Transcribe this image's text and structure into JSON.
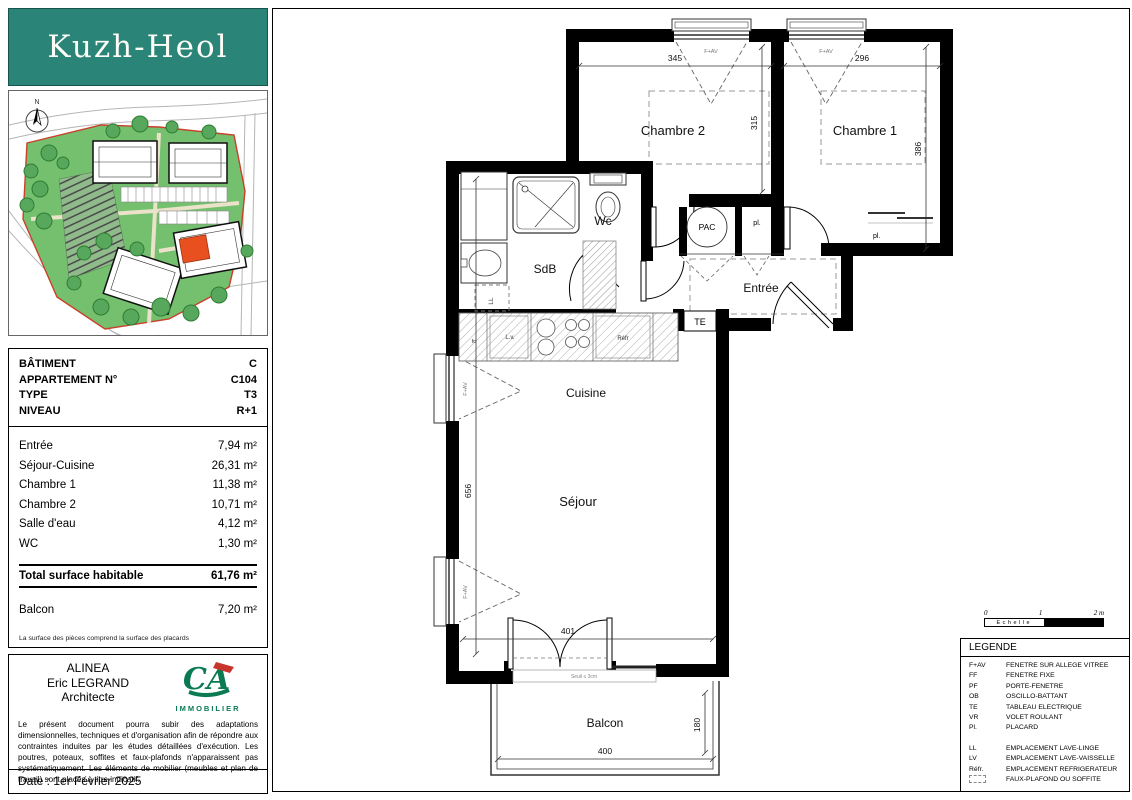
{
  "sidebar": {
    "brand": {
      "title": "Kuzh-Heol"
    },
    "info": {
      "rows": [
        {
          "label": "BÂTIMENT",
          "value": "C"
        },
        {
          "label": "APPARTEMENT N°",
          "value": "C104"
        },
        {
          "label": "TYPE",
          "value": "T3"
        },
        {
          "label": "NIVEAU",
          "value": "R+1"
        }
      ]
    },
    "areas": {
      "rows": [
        {
          "label": "Entrée",
          "value": "7,94 m²"
        },
        {
          "label": "Séjour-Cuisine",
          "value": "26,31 m²"
        },
        {
          "label": "Chambre 1",
          "value": "11,38 m²"
        },
        {
          "label": "Chambre 2",
          "value": "10,71 m²"
        },
        {
          "label": "Salle d'eau",
          "value": "4,12 m²"
        },
        {
          "label": "WC",
          "value": "1,30 m²"
        }
      ],
      "total": {
        "label": "Total surface habitable",
        "value": "61,76 m²"
      },
      "balcony": {
        "label": "Balcon",
        "value": "7,20 m²"
      },
      "footnote": "La surface des pièces comprend la surface des placards"
    },
    "architect": {
      "firm": "ALINEA",
      "name": "Eric LEGRAND",
      "role": "Architecte",
      "logo": "IMMOBILIER",
      "disclaimer": "Le présent document pourra subir des adaptations dimensionnelles, techniques et d'organisation afin de répondre aux contraintes induites par les études détaillées d'exécution. Les poutres, poteaux, soffites et faux-plafonds n'apparaissent pas systématiquement. Les éléments de mobilier (meubles et plan de travail) sont placés à titre indicatif.",
      "date": "Date : 1er Février 2025"
    }
  },
  "plan": {
    "rooms": {
      "chambre2": "Chambre 2",
      "chambre1": "Chambre 1",
      "wc": "Wc",
      "sdb": "SdB",
      "entree": "Entrée",
      "cuisine": "Cuisine",
      "sejour": "Séjour",
      "balcon": "Balcon"
    },
    "labels": {
      "pac": "PAC",
      "pl": "pl.",
      "te": "TE",
      "ll": "LL",
      "lv": "L.v.",
      "refr": "Réfr",
      "fo": "fo",
      "fav": "F+AV"
    },
    "dims": {
      "d345": "345",
      "d296": "296",
      "d315": "315",
      "d386": "386",
      "d656": "656",
      "d401": "401",
      "d400": "400",
      "d180": "180"
    },
    "threshold": "Seuil ≤ 3cm"
  },
  "scale": {
    "t0": "0",
    "t1": "1",
    "t2": "2 m",
    "label": "Echelle"
  },
  "legend": {
    "title": "LEGENDE",
    "group1": [
      {
        "abbr": "F+AV",
        "label": "FENETRE SUR ALLEGE VITREE"
      },
      {
        "abbr": "FF",
        "label": "FENETRE FIXE"
      },
      {
        "abbr": "PF",
        "label": "PORTE-FENETRE"
      },
      {
        "abbr": "OB",
        "label": "OSCILLO-BATTANT"
      },
      {
        "abbr": "TE",
        "label": "TABLEAU ELECTRIQUE"
      },
      {
        "abbr": "VR",
        "label": "VOLET ROULANT"
      },
      {
        "abbr": "Pl.",
        "label": "PLACARD"
      }
    ],
    "group2": [
      {
        "abbr": "LL",
        "label": "EMPLACEMENT LAVE-LINGE"
      },
      {
        "abbr": "LV",
        "label": "EMPLACEMENT LAVE-VAISSELLE"
      },
      {
        "abbr": "Réfr.",
        "label": "EMPLACEMENT REFRIGERATEUR"
      }
    ],
    "faux": {
      "label": "FAUX-PLAFOND OU SOFFITE"
    }
  }
}
